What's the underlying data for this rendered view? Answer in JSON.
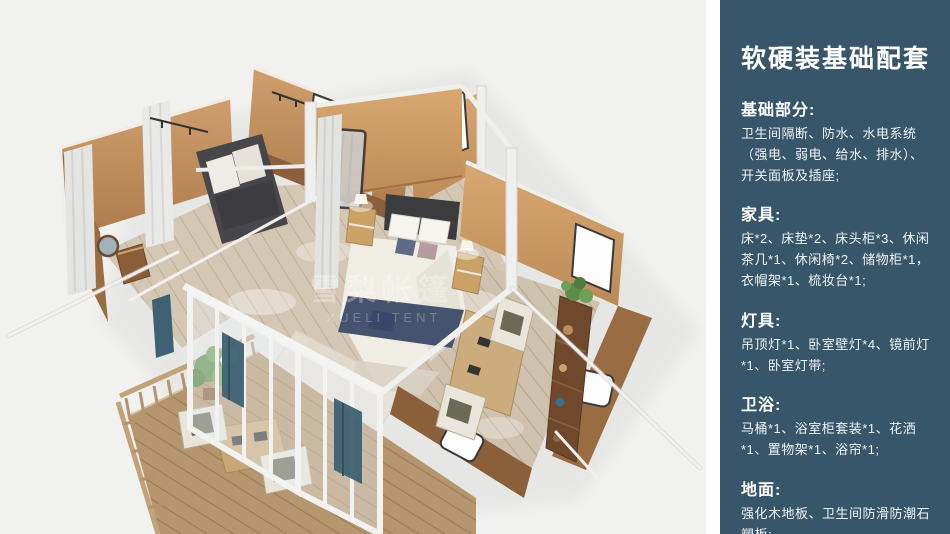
{
  "panel": {
    "bg": "#385669",
    "title": "软硬装基础配套",
    "sections": [
      {
        "title": "基础部分:",
        "body": "卫生间隔断、防水、水电系统（强电、弱电、给水、排水）、开关面板及插座;"
      },
      {
        "title": "家具:",
        "body": "床*2、床垫*2、床头柜*3、休闲茶几*1、休闲椅*2、储物柜*1，衣帽架*1、梳妆台*1;"
      },
      {
        "title": "灯具:",
        "body": "吊顶灯*1、卧室壁灯*4、镜前灯*1、卧室灯带;"
      },
      {
        "title": "卫浴:",
        "body": "马桶*1、浴室柜套装*1、花洒*1、置物架*1、浴帘*1;"
      },
      {
        "title": "地面:",
        "body": "强化木地板、卫生间防滑防潮石塑板;"
      }
    ]
  },
  "illustration": {
    "watermark_zh": "雪梨帐篷",
    "watermark_en": "XUELI TENT",
    "colors": {
      "canvas_bg": "#f1f1f0",
      "wall_lit": "#c99a68",
      "wall": "#c08a58",
      "wall_dark": "#8a5f3a",
      "floor_wood": "#d4c8b5",
      "deck_wood": "#b5966f",
      "frame_white": "#efefee",
      "bed_navy": "#46536f",
      "curtain_teal": "#3e6173",
      "plant_green": "#5d8b4a"
    }
  }
}
